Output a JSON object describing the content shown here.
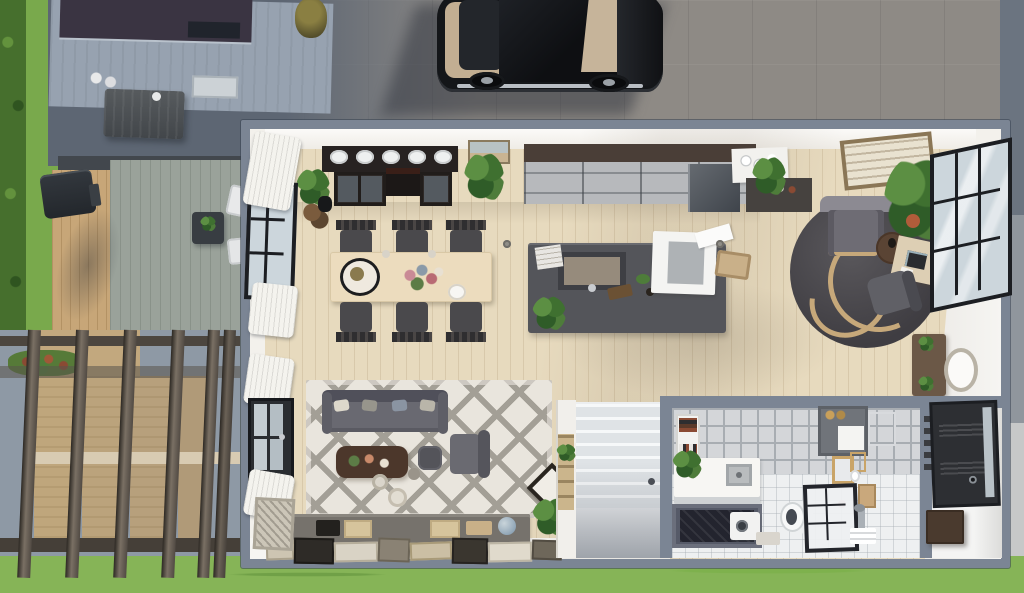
{
  "scene": {
    "title": "Top-down floor plan view of a modern loft house with yard, deck pergola and parked car",
    "view": "overhead build-mode floor plan",
    "outdoor": {
      "items": [
        "hedge",
        "lawn",
        "neighbor-building-roof",
        "roof-skylight",
        "building-door",
        "dumpster",
        "trash-barrel",
        "scattered-papers",
        "concrete-pavement",
        "parked-black-muscle-car",
        "bbq-grill",
        "patio-side-table",
        "lounge-chairs",
        "wood-deck",
        "gray-plank-deck",
        "pergola-beams",
        "flower-bush"
      ]
    },
    "rooms": [
      {
        "name": "kitchen",
        "items": [
          "black-stove-counter",
          "five-plates-of-food",
          "glass-cabinets",
          "wall-art-small",
          "steel-cabinet-run",
          "fridge",
          "white-coffee-counter",
          "dark-bar-counter",
          "hanging-plant",
          "large-wall-art",
          "potted-plants"
        ]
      },
      {
        "name": "dining-area",
        "items": [
          "wood-dining-table",
          "six-spindle-chairs",
          "serving-plate",
          "flower-centerpiece",
          "white-bowl"
        ]
      },
      {
        "name": "kitchen-island",
        "items": [
          "sink",
          "faucet",
          "book-stack",
          "cutting-board",
          "open-dishwasher",
          "bread-tray",
          "potted-plant",
          "floor-lights"
        ]
      },
      {
        "name": "office-corner",
        "items": [
          "round-dark-rug-with-rope",
          "gray-armchair",
          "round-side-table",
          "monstera-plant",
          "small-plant",
          "writing-desk",
          "laptop",
          "desk-chair",
          "industrial-window-wall",
          "console-table",
          "oval-mirror"
        ]
      },
      {
        "name": "living-room",
        "items": [
          "diamond-pattern-rug",
          "gray-sofa",
          "throw-pillows",
          "dark-coffee-table",
          "square-pouf",
          "gray-armchair",
          "floor-vases",
          "diamond-picture-frame",
          "ladder-shelf",
          "media-console",
          "leaning-gallery-frames",
          "leaning-art",
          "potted-plant",
          "curtained-windows",
          "glass-door"
        ]
      },
      {
        "name": "staircase",
        "items": [
          "white-stairs",
          "newel-knob",
          "side-wall"
        ]
      },
      {
        "name": "bathroom",
        "items": [
          "tiled-wall",
          "book-shelf",
          "white-vanity",
          "sink",
          "plant",
          "dark-shower-pit",
          "washer",
          "wall-cabinet",
          "gold-mirror",
          "towel-ring",
          "toilet",
          "framed-shower-glass",
          "floor-faucet",
          "towel-rail",
          "wall-shelf",
          "toiletry-box"
        ]
      },
      {
        "name": "entryway",
        "items": [
          "black-front-door",
          "door-glass-sidelight",
          "door-handle",
          "dark-bench"
        ]
      }
    ]
  },
  "palette": {
    "wall": "#7b8594",
    "wallwhite": "#f3f1ec",
    "floor": "#e7dabe",
    "grass": "#79a94c",
    "grassl": "#86b457",
    "hedge": "#466f2d",
    "roof": "#3a3442",
    "bldg": "#97a2b0",
    "pavew": "#8e8a85",
    "pavec": "#5d6673",
    "decktan": "#c7a678",
    "deckgray": "#9aa29a",
    "beam": "#564f47",
    "cdark": "#272221",
    "cabbrown": "#4a3e37",
    "steel": "#b7b9bc",
    "island": "#54555a",
    "tablewood": "#ecdcbe",
    "chair": "#39383a",
    "rugl": "#e9e5dd",
    "rugd": "#a39f96",
    "sofa": "#696971",
    "rrug": "#46444a",
    "rope": "#c6a87a",
    "tile": "#d4d6d9",
    "grout": "#a8adb2",
    "bathfloor": "#eef0f1",
    "doordark": "#2d2f33",
    "winframe": "#1c1e22",
    "pane": "#ccd6dc",
    "curtain": "#f4f3ee",
    "frametan": "#c9b288",
    "woodbrown": "#6b5847",
    "plantg": "#4e7c3a",
    "white": "#f6f5f2"
  }
}
